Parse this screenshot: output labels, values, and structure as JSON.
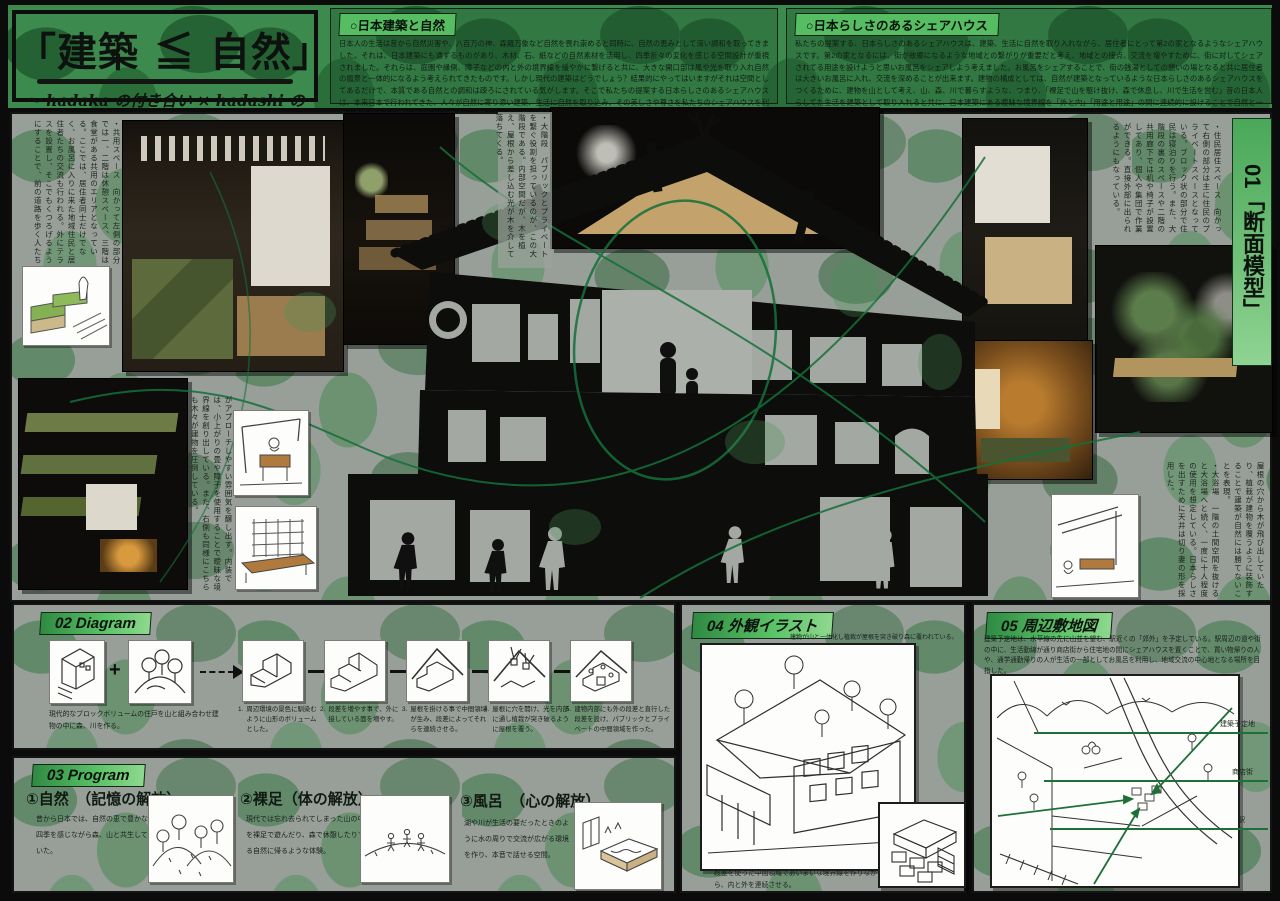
{
  "poster": {
    "title": "「建築 ≦ 自然」",
    "subtitle": "〜 hadaka の付き合い × hadashi の付き合い 〜"
  },
  "colors": {
    "accent_green": "#57bd62",
    "leaf_green": "#2f7340",
    "line_green": "#1e6f38"
  },
  "intro_left": {
    "heading": "○日本建築と自然",
    "body": "日本人の生活は昔から自然災害や、八百万の神、森羅万象など自然を畏れ崇めると同時に、自然の恵みとして深い調和を取ってきました。それは、日本建築にも通ずるものがあり、木材、石、紙などの自然素材を活用し、四季折々の変化を感じる空間設計が重視されました。それらは、庭園や縁側、障子などの内と外の境界線を緩やかに繋げると共に、大きな開口部は風や光を取り入れ自然の風景と一体的になるよう考えられてきたものです。しかし現代の建築はどうでしょう？結果的にやってはいますがそれは空間としてあるだけで、本質である自然との調和は疎ろにされている気がします。そこで私たちの提案する日本らしさのあるシェアハウスは、本来日本で行われてきた、人々が自然に寄り添い建築、生活に自然を取り込み、その美しさや尊さを私たちのシェアハウスを利用する全ての人が感じることが出来るシェアハウスを提案します。"
  },
  "intro_right": {
    "heading": "○日本らしさのあるシェアハウス",
    "body": "私たちの提案する、日本らしさのあるシェアハウスは、建築、生活に自然を取り入れながら、居住者にとって第2の家となるようなシェアハウスです。第2の家となるには、街が故郷になるような地域との繋がりが重要だと考え、地域との接点、交流を増やすために、街に対してシェアされてる用途を設けようと思いお風呂をシェアしよう考えました。お風呂をシェアすることで、街の銭湯としての憩いの場となると共に居住者は大きいお風呂に入れ、交流を深めることが出来ます。建物の構成としては、自然が建築となっているような日本らしさのあるシェアハウスをつくるために、建物を山として考え、山、森、川で暮らすような、つまり、「裸足で山を駆け抜け、森で休息し、川で生活を営む」昔の日本人らしてた生活を建築として取り入れると共に、日本建築にある曖昧な境界線を「外と内」「用途と用途」の間に連続的に設けることで自然と一体的になるような空間を作りました。"
  },
  "section01": {
    "label": "01「断面模型」",
    "caption_common": "・共用スペース　向かって左側の部分では一、二階は休憩スペース、三階は食堂がある共用のエリアとなっている。ここでは、居住者同士だけでなく、お風呂に入りに来た地域住民と居住者たちの交流も行われる。外にテラスを設置し、そこでもくつろげるようにすることで、前の道路を歩く人たち",
    "caption_approach": "がアプローチしやすい雰囲気を醸し出す。内装では、小上がりの畳や障子を使用することで曖昧な境界線を創り出している。また、右側も同様にこちらも木々が建物を圧倒している。",
    "caption_stairs": "・大階段　パブリックとプライベートを繋ぐ役割を担っているのが、この大階段である。内部空間だが、木を植え、屋根から差し込む光が木を介して落ちてくる。",
    "caption_living": "・住民居住スペース　向かって右側の部分は主に住民のプライベートスペースとなっている。ブロック状の部分で住民は寝泊りを行う。また、大階段の裏のスペースや二階の共用廊下では机や椅子が設置してあり、個人や集団で作業ができる。直接外部に出られるようにもなっている。",
    "caption_nature": "屋根の穴から木が飛び出していたり、植栽が建物を覆うように装飾することで建築が自然には勝てないことを表現。",
    "caption_bath": "・大浴場　一階の土間空間を抜けると大浴場へと続く、一度に十人程度の使用を想定している。日本らしさを出すために天井は切り妻の形を採用した。"
  },
  "section02": {
    "label": "02 Diagram",
    "plus": "+",
    "base_caption": "現代的なブロックボリュームの住戸を山と組み合わせ建物の中に森、川を作る。",
    "steps": [
      {
        "num": "1.",
        "text": "周辺環境の景色に馴染むように山形のボリュームとした。"
      },
      {
        "num": "2.",
        "text": "段差を増やす事で、外に接している面を増やす。"
      },
      {
        "num": "3.",
        "text": "屋根を掛ける事で中間領域が生み、段差によってそれらを連続させる。"
      },
      {
        "num": "4.",
        "text": "屋根に穴を開け、光を内部に通し植栽が突き破るように屋根を覆う。"
      },
      {
        "num": "5.",
        "text": "建物内部にも外の段差と直行した段差を設け、パブリックとプライベートの中間領域を作った。"
      }
    ]
  },
  "section03": {
    "label": "03 Program",
    "items": [
      {
        "heading": "①自然　（記憶の解放）",
        "body": "昔から日本では、自然の恵で豊かな四季を感じながら森、山と共生していた。"
      },
      {
        "heading": "②裸足（体の解放）",
        "body": "現代では忘れ去られてしまった山の中を裸足で遊んだり、森で休憩したりする自然に帰るような体験。"
      },
      {
        "heading": "③風呂　（心の解放）",
        "body": "湖や川が生活の要だったときのように水の周りで交流が広がる環境を作り、本音で話せる空間。"
      }
    ]
  },
  "section04": {
    "label": "04 外観イラスト",
    "caption_top": "建物が山と一体化し植栽が屋根を突き破り森に覆われている。",
    "caption_bottom": "段差を使った中間領域であいまいな境界線を作りながら、内と外を連続させる。"
  },
  "section05": {
    "label": "05 周辺敷地図",
    "body": "建築予定地は、水平線の先に山並を望む、駅近くの「郊外」を予定している。駅周辺の道や街の中に、生活動線が通り商店街から住宅地の間にシェアハウスを置くことで、買い物帰りの人や、通学通勤帰りの人が生活の一部としてお風呂を利用し、地域交流の中心地となる場所を目指した。",
    "map_labels": [
      "建築予定地",
      "商店街",
      "駅"
    ]
  }
}
